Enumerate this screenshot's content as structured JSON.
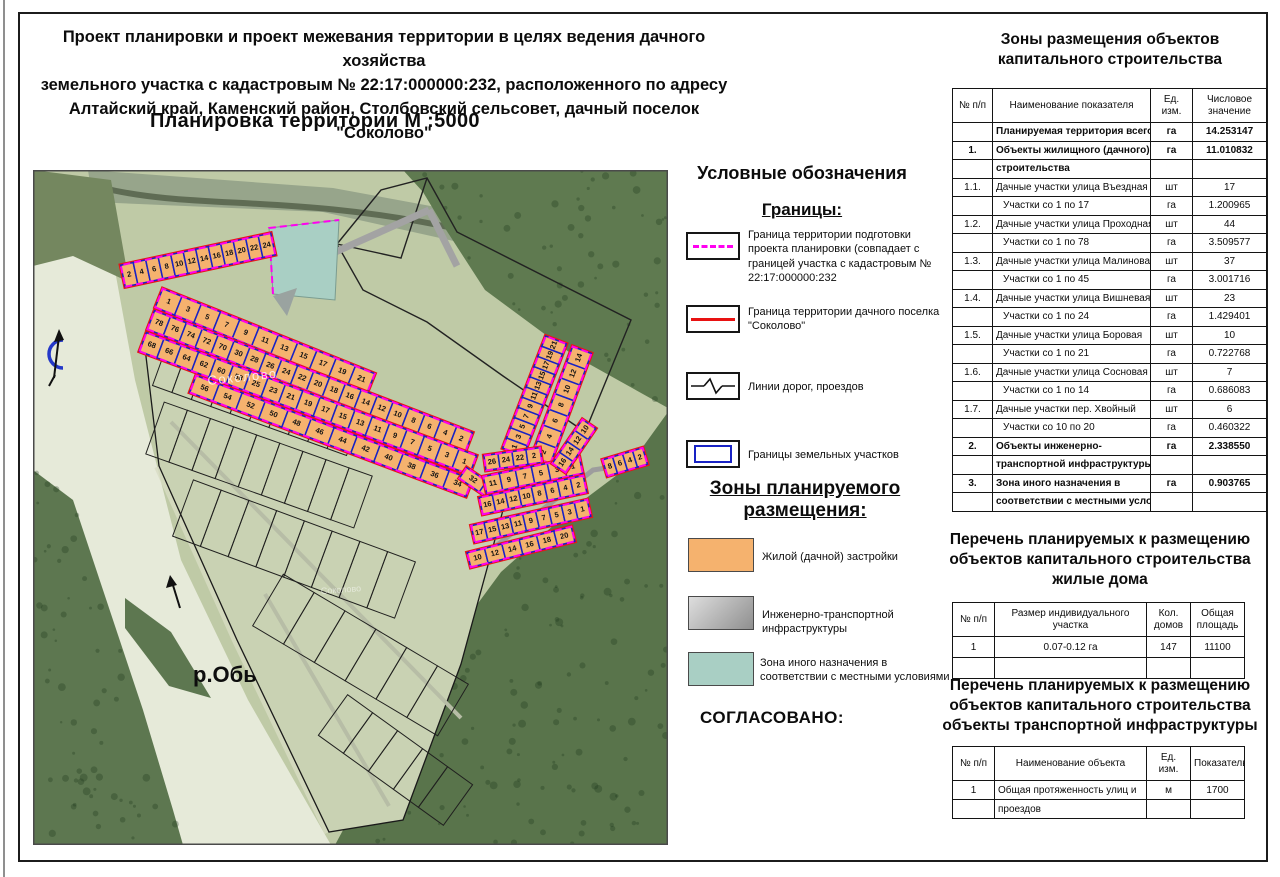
{
  "header": {
    "title_lines": [
      "Проект планировки и проект межевания территории в целях ведения дачного хозяйства",
      "земельного участка с кадастровым № 22:17:000000:232, расположенного по адресу",
      "Алтайский край, Каменский район, Столбовский сельсовет, дачный поселок \"Соколово\""
    ],
    "map_title": "Планировка территории  М :5000"
  },
  "legend": {
    "heading": "Условные обозначения",
    "boundaries_heading": "Границы:",
    "items": [
      {
        "label": "Граница территории подготовки проекта планировки (совпадает с границей участка с кадастровым № 22:17:000000:232"
      },
      {
        "label": "Граница территории дачного поселка \"Соколово\""
      },
      {
        "label": "Линии дорог, проездов"
      },
      {
        "label": "Границы земельных участков"
      }
    ],
    "zones_heading": "Зоны планируемого размещения:",
    "zones": [
      {
        "label": "Жилой (дачной) застройки",
        "color": "#F5B26E"
      },
      {
        "label": "Инженерно-транспортной инфраструктуры",
        "color": "#bdbdbd"
      },
      {
        "label": "Зона иного назначения в соответствии с местными условиями",
        "color": "#A9CFC4"
      }
    ]
  },
  "approved_label": "СОГЛАСОВАНО:",
  "map": {
    "river_label": "р.Обь",
    "settlement_label": "Соколово",
    "colors": {
      "parcel_fill": "#F5B26E",
      "parcel_stroke": "#1822c4",
      "project_boundary": "#ff00f0",
      "settlement_boundary": "#e81616",
      "other_zone": "#A9CFC4"
    },
    "strips": [
      {
        "street": "Въездная",
        "x1": 90,
        "y1": 106,
        "x2": 240,
        "y2": 74,
        "w": 22,
        "numbers": [
          "2",
          "4",
          "6",
          "8",
          "10",
          "12",
          "14",
          "16",
          "18",
          "20",
          "22",
          "24"
        ]
      },
      {
        "street": "Проходная",
        "x1": 126,
        "y1": 128,
        "x2": 338,
        "y2": 213,
        "w": 20,
        "numbers": [
          "1",
          "3",
          "5",
          "7",
          "9",
          "11",
          "13",
          "15",
          "17",
          "19",
          "21"
        ]
      },
      {
        "street": "Проходная",
        "x1": 118,
        "y1": 150,
        "x2": 436,
        "y2": 272,
        "w": 20,
        "numbers": [
          "78",
          "76",
          "74",
          "72",
          "70",
          "30",
          "28",
          "26",
          "24",
          "22",
          "20",
          "18",
          "16",
          "14",
          "12",
          "10",
          "8",
          "6",
          "4",
          "2"
        ]
      },
      {
        "street": "Малиновая",
        "x1": 110,
        "y1": 172,
        "x2": 440,
        "y2": 295,
        "w": 20,
        "numbers": [
          "68",
          "66",
          "64",
          "62",
          "60",
          "58",
          "25",
          "23",
          "21",
          "19",
          "17",
          "15",
          "13",
          "11",
          "9",
          "7",
          "5",
          "3",
          "1"
        ]
      },
      {
        "street": "Вишневая",
        "x1": 160,
        "y1": 214,
        "x2": 436,
        "y2": 318,
        "w": 18,
        "numbers": [
          "56",
          "54",
          "52",
          "50",
          "48",
          "46",
          "44",
          "42",
          "40",
          "38",
          "36",
          "34"
        ]
      },
      {
        "street": "Вишневая",
        "x1": 430,
        "y1": 303,
        "x2": 470,
        "y2": 330,
        "w": 13,
        "numbers": [
          "32",
          "30"
        ]
      },
      {
        "street": "Боровая",
        "x1": 480,
        "y1": 282,
        "x2": 523,
        "y2": 170,
        "w": 22,
        "numbers": [
          "1",
          "3",
          "5",
          "7",
          "9",
          "11",
          "13",
          "15",
          "17",
          "19",
          "21"
        ]
      },
      {
        "street": "Боровая",
        "x1": 508,
        "y1": 290,
        "x2": 549,
        "y2": 180,
        "w": 20,
        "numbers": [
          "2",
          "4",
          "6",
          "8",
          "10",
          "12",
          "14"
        ]
      },
      {
        "street": "Боровая",
        "x1": 452,
        "y1": 293,
        "x2": 508,
        "y2": 285,
        "w": 15,
        "numbers": [
          "26",
          "24",
          "22",
          "2"
        ]
      },
      {
        "street": "Сосновая",
        "x1": 452,
        "y1": 315,
        "x2": 548,
        "y2": 295,
        "w": 17,
        "numbers": [
          "11",
          "9",
          "7",
          "5",
          "3",
          "1"
        ]
      },
      {
        "street": "Сосновая",
        "x1": 448,
        "y1": 336,
        "x2": 552,
        "y2": 314,
        "w": 17,
        "numbers": [
          "16",
          "14",
          "12",
          "10",
          "8",
          "6",
          "4",
          "2"
        ]
      },
      {
        "street": "Хвойный",
        "x1": 440,
        "y1": 364,
        "x2": 556,
        "y2": 338,
        "w": 17,
        "numbers": [
          "17",
          "15",
          "13",
          "11",
          "9",
          "7",
          "5",
          "3",
          "1"
        ]
      },
      {
        "street": "Хвойный",
        "x1": 436,
        "y1": 390,
        "x2": 540,
        "y2": 364,
        "w": 15,
        "numbers": [
          "10",
          "12",
          "14",
          "16",
          "18",
          "20"
        ]
      },
      {
        "street": "Боровая",
        "x1": 526,
        "y1": 298,
        "x2": 556,
        "y2": 254,
        "w": 16,
        "numbers": [
          "16",
          "14",
          "12",
          "10"
        ]
      },
      {
        "street": "Сосновая",
        "x1": 572,
        "y1": 298,
        "x2": 612,
        "y2": 286,
        "w": 17,
        "numbers": [
          "8",
          "6",
          "4",
          "2"
        ]
      }
    ]
  },
  "tables": {
    "zones_table": {
      "title": "Зоны размещения объектов капитального строительства",
      "columns": [
        "№ п/п",
        "Наименование показателя",
        "Ед. изм.",
        "Числовое значение"
      ],
      "rows": [
        {
          "n": "",
          "t": "Планируемая территория всего",
          "u": "га",
          "v": "14.253147",
          "b": true
        },
        {
          "n": "1.",
          "t": "Объекты жилищного (дачного)",
          "u": "га",
          "v": "11.010832",
          "b": true
        },
        {
          "n": "",
          "t": "строительства",
          "u": "",
          "v": "",
          "b": true
        },
        {
          "n": "1.1.",
          "t": "Дачные участки улица Въездная",
          "u": "шт",
          "v": "17"
        },
        {
          "n": "",
          "t": "Участки со 1 по 17",
          "u": "га",
          "v": "1.200965",
          "i": true
        },
        {
          "n": "1.2.",
          "t": "Дачные участки улица Проходная",
          "u": "шт",
          "v": "44"
        },
        {
          "n": "",
          "t": "Участки со 1 по 78",
          "u": "га",
          "v": "3.509577",
          "i": true
        },
        {
          "n": "1.3.",
          "t": "Дачные участки улица Малиновая",
          "u": "шт",
          "v": "37"
        },
        {
          "n": "",
          "t": "Участки со 1 по 45",
          "u": "га",
          "v": "3.001716",
          "i": true
        },
        {
          "n": "1.4.",
          "t": "Дачные участки улица Вишневая",
          "u": "шт",
          "v": "23"
        },
        {
          "n": "",
          "t": "Участки со 1 по 24",
          "u": "га",
          "v": "1.429401",
          "i": true
        },
        {
          "n": "1.5.",
          "t": "Дачные участки улица Боровая",
          "u": "шт",
          "v": "10"
        },
        {
          "n": "",
          "t": "Участки со 1 по 21",
          "u": "га",
          "v": "0.722768",
          "i": true
        },
        {
          "n": "1.6.",
          "t": "Дачные участки улица Сосновая",
          "u": "шт",
          "v": "7"
        },
        {
          "n": "",
          "t": "Участки со 1 по 14",
          "u": "га",
          "v": "0.686083",
          "i": true
        },
        {
          "n": "1.7.",
          "t": "Дачные участки пер. Хвойный",
          "u": "шт",
          "v": "6"
        },
        {
          "n": "",
          "t": "Участки со 10 по 20",
          "u": "га",
          "v": "0.460322",
          "i": true
        },
        {
          "n": "2.",
          "t": "Объекты инженерно-",
          "u": "га",
          "v": "2.338550",
          "b": true
        },
        {
          "n": "",
          "t": "транспортной инфраструктуры",
          "u": "",
          "v": "",
          "b": true
        },
        {
          "n": "3.",
          "t": "Зона иного назначения в",
          "u": "га",
          "v": "0.903765",
          "b": true
        },
        {
          "n": "",
          "t": "соответствии с местными условиями",
          "u": "",
          "v": "",
          "b": true
        }
      ]
    },
    "houses_table": {
      "title": "Перечень планируемых к размещению объектов капитального строительства жилые дома",
      "columns": [
        "№ п/п",
        "Размер индивидуального участка",
        "Кол. домов",
        "Общая площадь"
      ],
      "rows": [
        [
          "1",
          "0.07-0.12 га",
          "147",
          "11100"
        ],
        [
          "",
          "",
          "",
          ""
        ]
      ]
    },
    "transport_table": {
      "title": "Перечень планируемых к размещению объектов капитального строительства объекты транспортной инфраструктуры",
      "columns": [
        "№ п/п",
        "Наименование объекта",
        "Ед. изм.",
        "Показатель"
      ],
      "rows": [
        [
          "1",
          "Общая протяженность улиц и",
          "м",
          "1700"
        ],
        [
          "",
          "проездов",
          "",
          ""
        ]
      ]
    }
  }
}
